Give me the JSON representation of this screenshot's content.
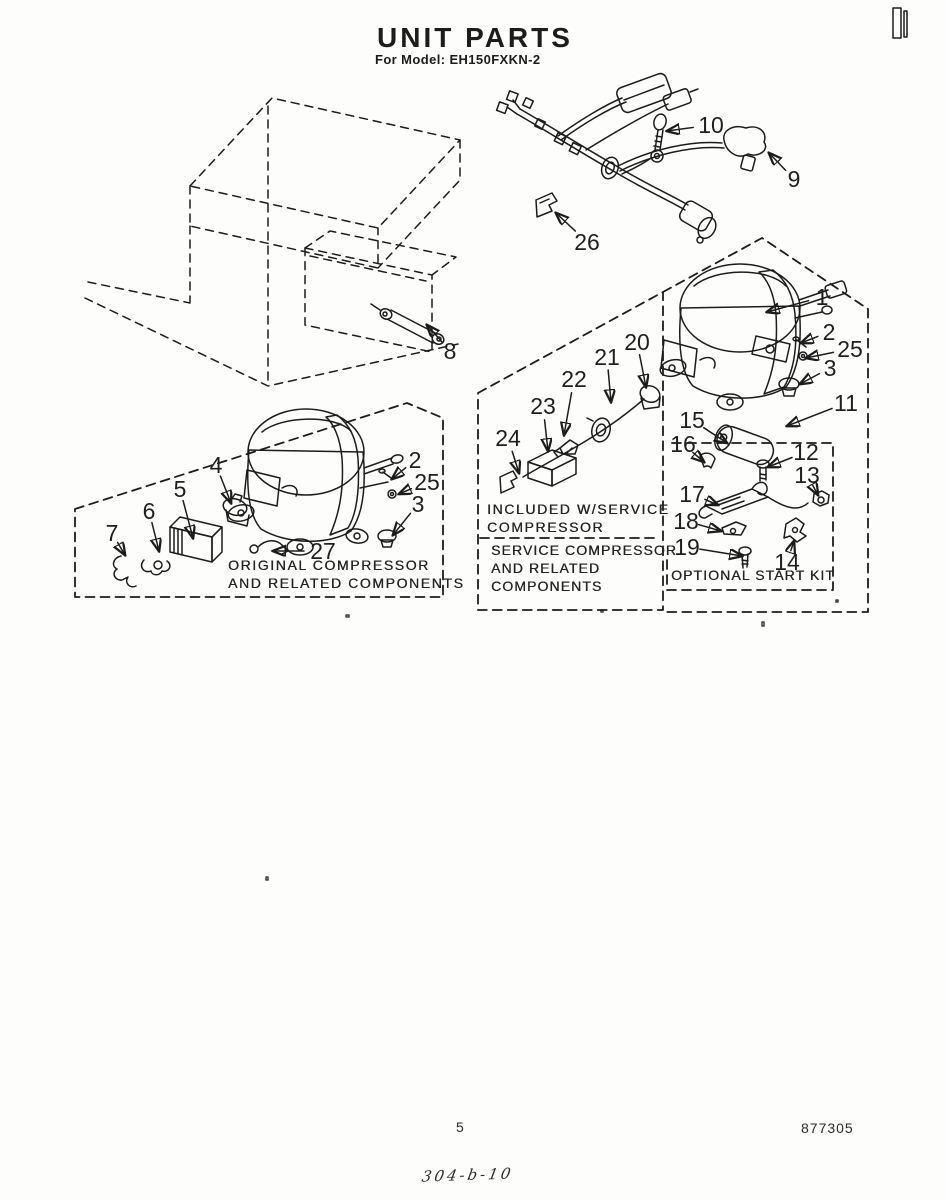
{
  "page": {
    "title": "UNIT PARTS",
    "subtitle": "For Model: EH150FXKN-2",
    "footer": {
      "page_number": "5",
      "doc_number": "877305",
      "handwritten_note": "304-b-10"
    }
  },
  "diagram": {
    "section_labels": {
      "original": "ORIGINAL COMPRESSOR\nAND RELATED COMPONENTS",
      "included": "INCLUDED W/SERVICE\nCOMPRESSOR",
      "service": "SERVICE COMPRESSOR\nAND RELATED\nCOMPONENTS",
      "optional": "OPTIONAL START KIT"
    },
    "callouts": [
      {
        "label": "10",
        "x": 711,
        "y": 125,
        "tx": 667,
        "ty": 131,
        "gap": 18
      },
      {
        "label": "9",
        "x": 794,
        "y": 179,
        "tx": 769,
        "ty": 153,
        "gap": 12
      },
      {
        "label": "26",
        "x": 587,
        "y": 242,
        "tx": 556,
        "ty": 213,
        "gap": 16
      },
      {
        "label": "8",
        "x": 450,
        "y": 351,
        "tx": 427,
        "ty": 325,
        "gap": 12
      },
      {
        "label": "1",
        "x": 822,
        "y": 297,
        "tx": 767,
        "ty": 312,
        "gap": 14
      },
      {
        "label": "2",
        "x": 829,
        "y": 332,
        "tx": 801,
        "ty": 343,
        "gap": 12
      },
      {
        "label": "25",
        "x": 850,
        "y": 349,
        "tx": 806,
        "ty": 358,
        "gap": 17
      },
      {
        "label": "3",
        "x": 830,
        "y": 368,
        "tx": 800,
        "ty": 384,
        "gap": 12
      },
      {
        "label": "11",
        "x": 846,
        "y": 403,
        "tx": 787,
        "ty": 426,
        "gap": 15
      },
      {
        "label": "15",
        "x": 692,
        "y": 420,
        "tx": 727,
        "ty": 443,
        "gap": 14
      },
      {
        "label": "16",
        "x": 683,
        "y": 444,
        "tx": 704,
        "ty": 462,
        "gap": 13
      },
      {
        "label": "12",
        "x": 806,
        "y": 452,
        "tx": 768,
        "ty": 467,
        "gap": 15
      },
      {
        "label": "13",
        "x": 807,
        "y": 475,
        "tx": 818,
        "ty": 495,
        "gap": 12
      },
      {
        "label": "17",
        "x": 692,
        "y": 494,
        "tx": 718,
        "ty": 505,
        "gap": 14
      },
      {
        "label": "18",
        "x": 686,
        "y": 521,
        "tx": 721,
        "ty": 531,
        "gap": 13
      },
      {
        "label": "19",
        "x": 687,
        "y": 547,
        "tx": 742,
        "ty": 556,
        "gap": 13
      },
      {
        "label": "14",
        "x": 787,
        "y": 562,
        "tx": 794,
        "ty": 541,
        "gap": 12
      },
      {
        "label": "20",
        "x": 637,
        "y": 342,
        "tx": 646,
        "ty": 387,
        "gap": 13
      },
      {
        "label": "21",
        "x": 607,
        "y": 357,
        "tx": 611,
        "ty": 402,
        "gap": 13
      },
      {
        "label": "22",
        "x": 574,
        "y": 379,
        "tx": 564,
        "ty": 435,
        "gap": 14
      },
      {
        "label": "23",
        "x": 543,
        "y": 406,
        "tx": 548,
        "ty": 451,
        "gap": 14
      },
      {
        "label": "24",
        "x": 508,
        "y": 438,
        "tx": 519,
        "ty": 473,
        "gap": 14
      },
      {
        "label": "4",
        "x": 216,
        "y": 465,
        "tx": 231,
        "ty": 503,
        "gap": 12
      },
      {
        "label": "5",
        "x": 180,
        "y": 489,
        "tx": 193,
        "ty": 538,
        "gap": 12
      },
      {
        "label": "6",
        "x": 149,
        "y": 511,
        "tx": 159,
        "ty": 551,
        "gap": 12
      },
      {
        "label": "7",
        "x": 112,
        "y": 533,
        "tx": 125,
        "ty": 555,
        "gap": 11
      },
      {
        "label": "2",
        "x": 415,
        "y": 460,
        "tx": 392,
        "ty": 479,
        "gap": 12
      },
      {
        "label": "25",
        "x": 427,
        "y": 482,
        "tx": 399,
        "ty": 494,
        "gap": 17
      },
      {
        "label": "3",
        "x": 418,
        "y": 504,
        "tx": 393,
        "ty": 535,
        "gap": 12
      },
      {
        "label": "27",
        "x": 323,
        "y": 551,
        "tx": 273,
        "ty": 551,
        "gap": 19
      }
    ]
  }
}
